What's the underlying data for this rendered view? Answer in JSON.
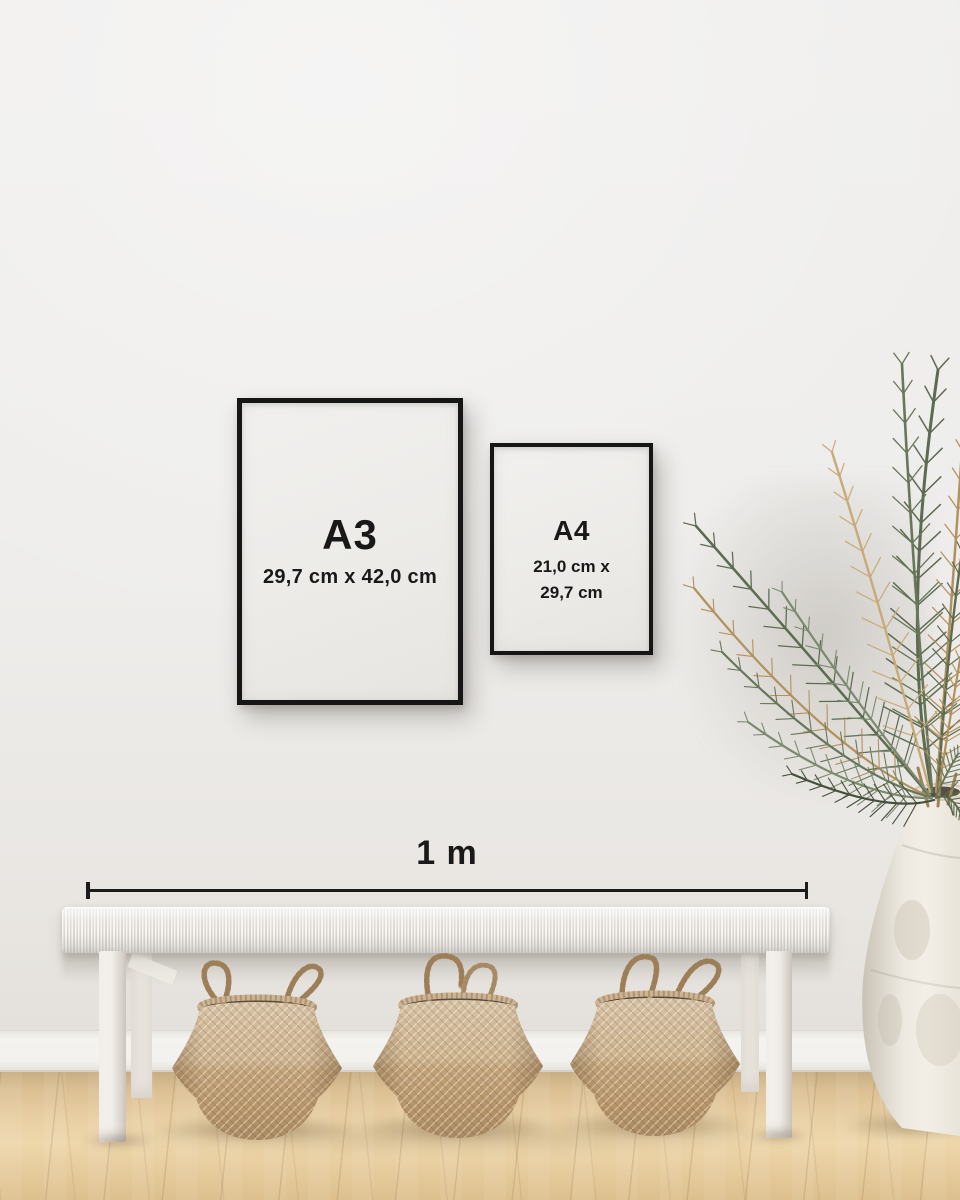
{
  "frames": {
    "a3": {
      "label": "A3",
      "dimensions": "29,7 cm x 42,0 cm"
    },
    "a4": {
      "label": "A4",
      "dimensions_line1": "21,0 cm x",
      "dimensions_line2": "29,7 cm"
    }
  },
  "scale": {
    "label": "1 m"
  },
  "colors": {
    "frame_border": "#161616",
    "text": "#191919",
    "scale_line": "#1c1c1c",
    "wall": "#efeeec",
    "baseboard": "#f4f2ee",
    "floor_light": "#eed7ab",
    "floor_dark": "#c9ad82",
    "bench": "#f3f1ec",
    "basket_light": "#d6c1a4",
    "basket_dark": "#aa8a60",
    "plant_green": "#5d6b50",
    "plant_dried": "#b3915e",
    "vase": "#ece8df"
  }
}
